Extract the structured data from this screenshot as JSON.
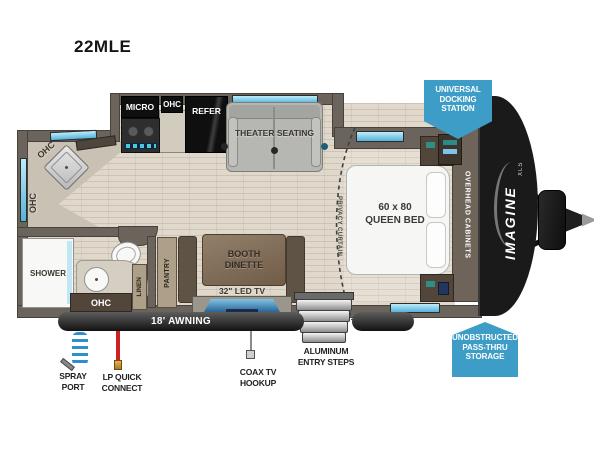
{
  "title": "22MLE",
  "floorplan": {
    "kitchen": {
      "micro": "MICRO",
      "ohc": "OHC",
      "refer": "REFER",
      "corner_ohc": "OHC",
      "left_ohc": "OHC"
    },
    "living": {
      "theater": "THEATER SEATING",
      "dinette": [
        "BOOTH",
        "DINETTE"
      ],
      "tv": "32\" LED TV",
      "pantry": "PANTRY"
    },
    "bath": {
      "shower": "SHOWER",
      "ohc": "OHC",
      "linen": "LINEN"
    },
    "bedroom": {
      "bed": [
        "60 x 80",
        "QUEEN BED"
      ],
      "overhead": "OVERHEAD CABINETS",
      "curtain": "PRIVACY CURTAIN"
    }
  },
  "exterior": {
    "awning": "18' AWNING",
    "steps": [
      "ALUMINUM",
      "ENTRY STEPS"
    ],
    "spray_port": [
      "SPRAY",
      "PORT"
    ],
    "lp_quick": [
      "LP QUICK",
      "CONNECT"
    ],
    "coax": [
      "COAX TV",
      "HOOKUP"
    ]
  },
  "badges": {
    "docking": [
      "UNIVERSAL",
      "DOCKING",
      "STATION"
    ],
    "storage": [
      "UNOBSTRUCTED",
      "PASS-THRU",
      "STORAGE"
    ]
  },
  "brand": {
    "name": "IMAGINE",
    "series": "XLS"
  },
  "colors": {
    "badge_blue": "#3e9dc6",
    "window_blue": "#7ecdec",
    "lp_red": "#cc2222",
    "hose_blue": "#2d8fd0"
  }
}
